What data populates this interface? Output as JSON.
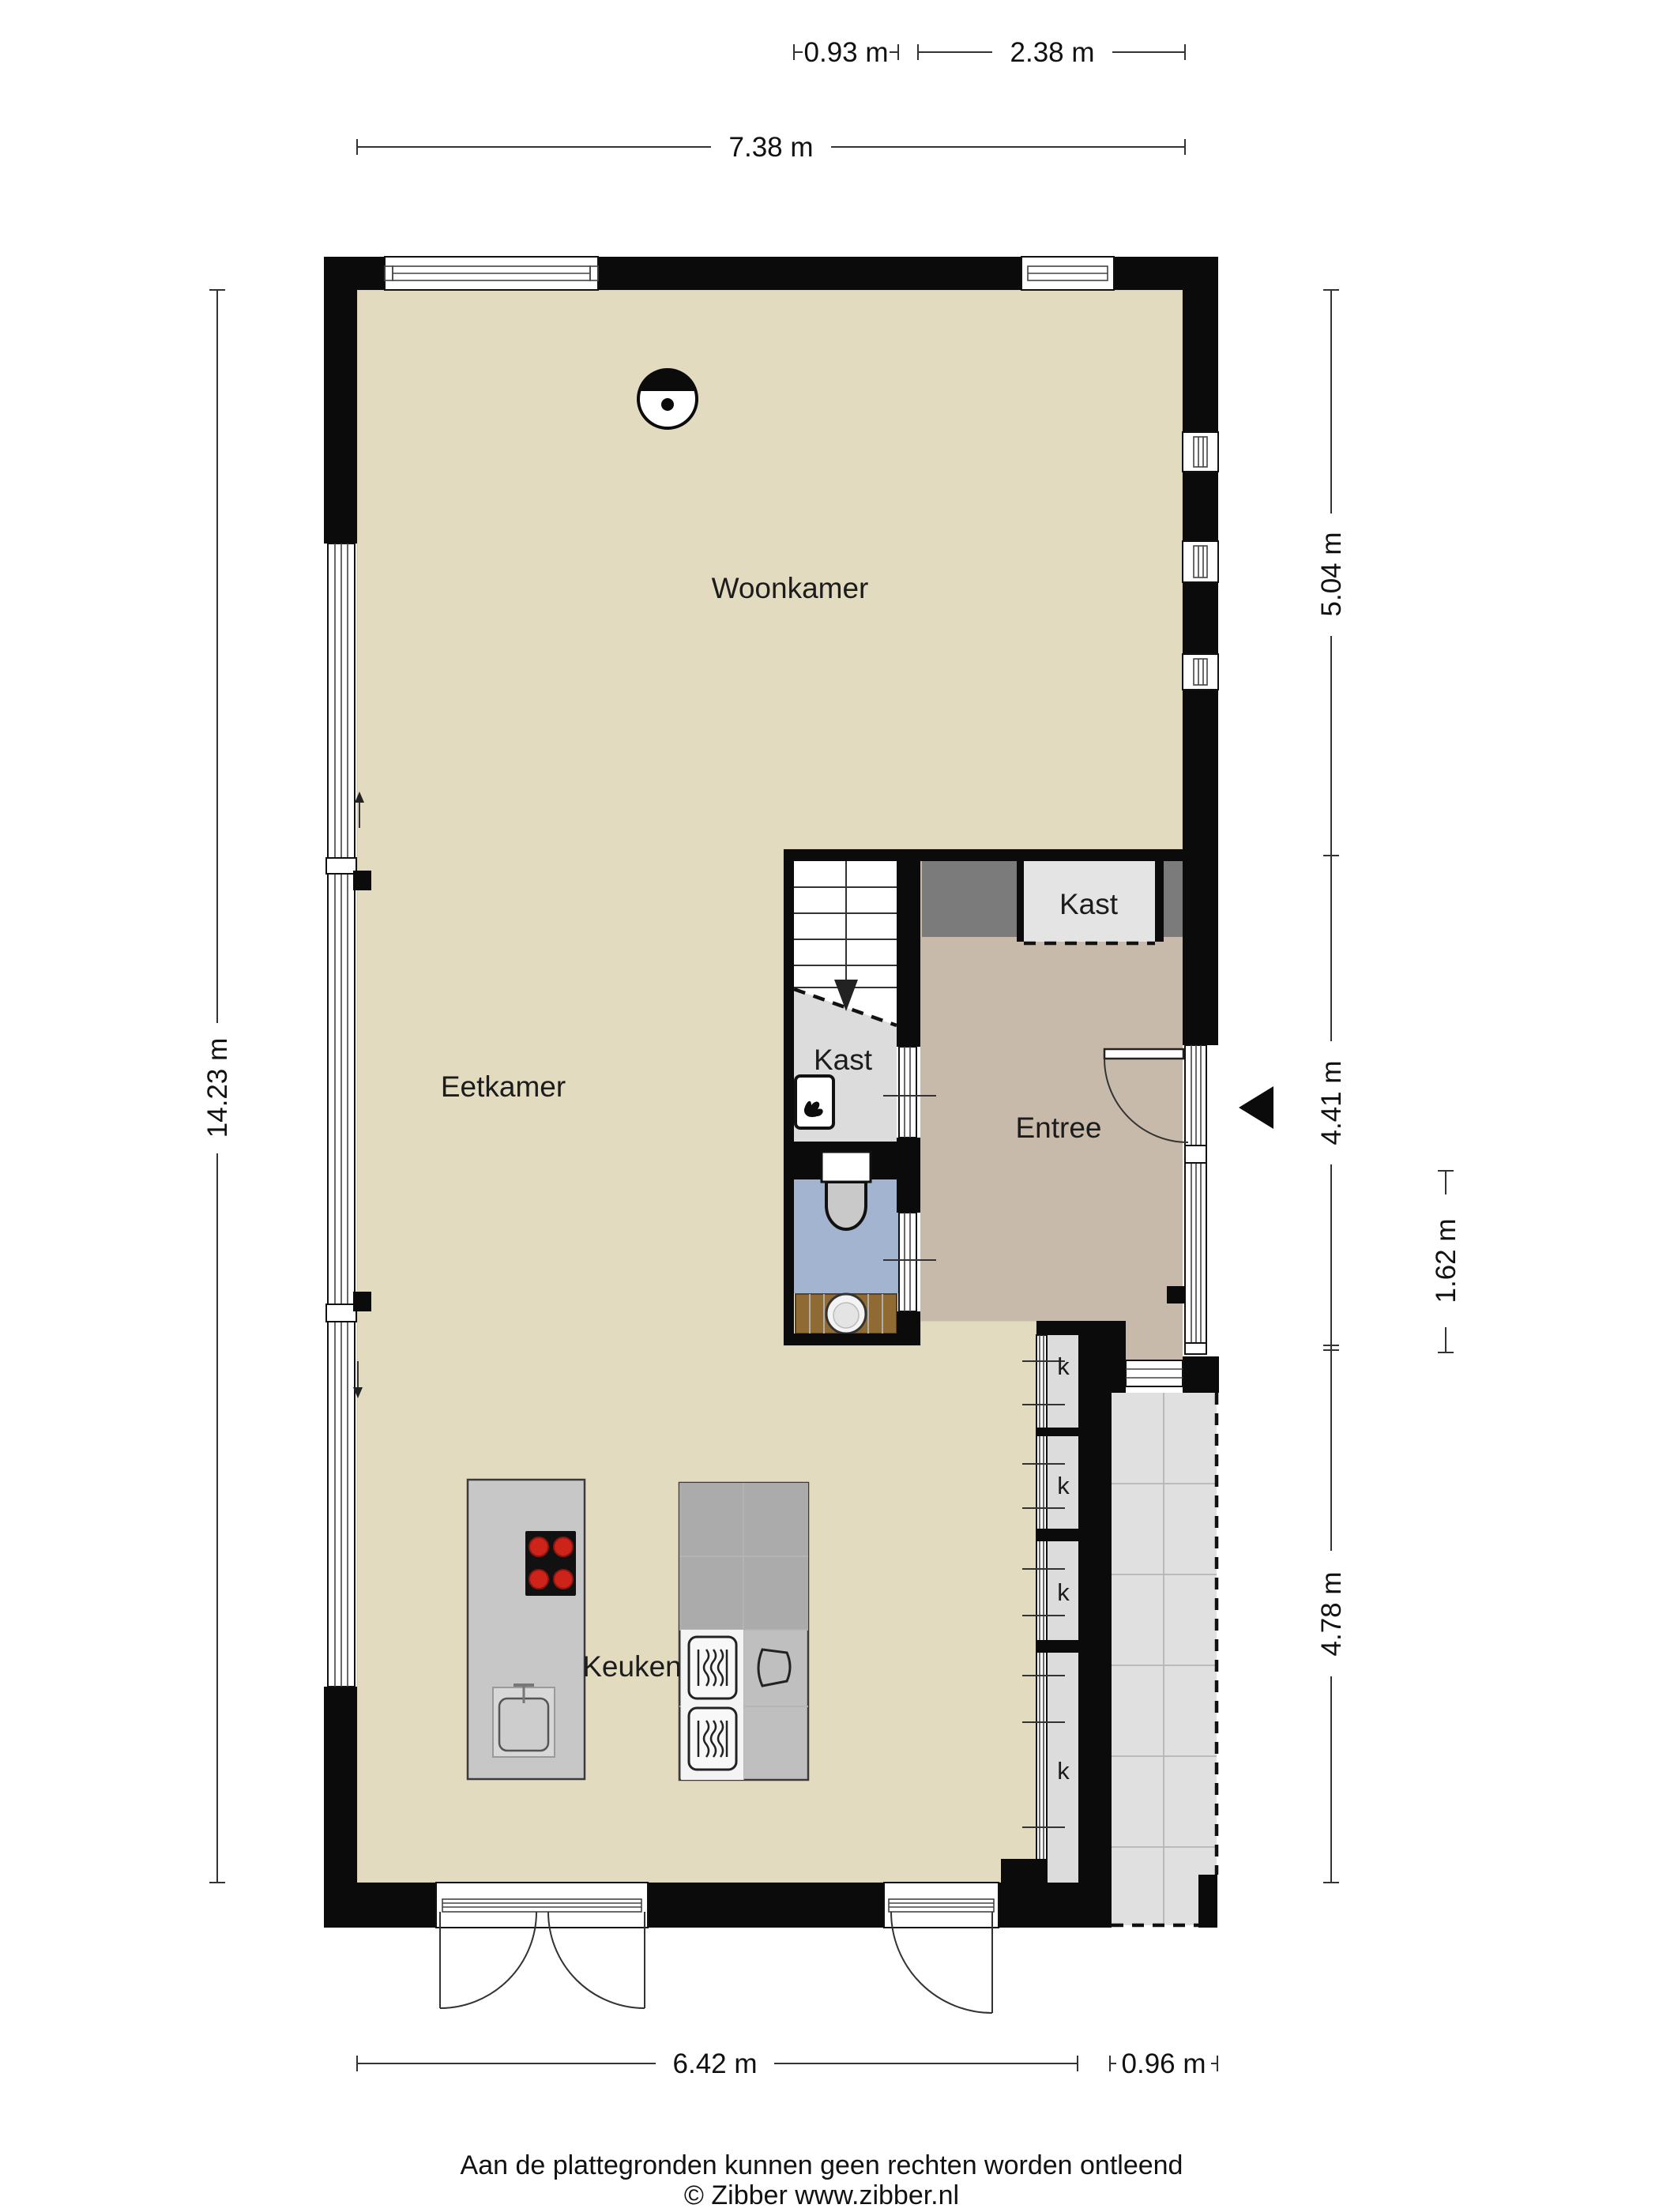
{
  "dims": {
    "w093": "0.93 m",
    "w238": "2.38 m",
    "w738": "7.38 m",
    "h1423": "14.23 m",
    "h504": "5.04 m",
    "h441": "4.41 m",
    "h162": "1.62 m",
    "h478": "4.78 m",
    "w642": "6.42 m",
    "w096": "0.96 m"
  },
  "rooms": {
    "woonkamer": "Woonkamer",
    "eetkamer": "Eetkamer",
    "keuken": "Keuken",
    "entree": "Entree",
    "kast_top": "Kast",
    "kast_stairs": "Kast",
    "k1": "k",
    "k2": "k",
    "k3": "k",
    "k4": "k"
  },
  "footer": {
    "disclaimer": "Aan de plattegronden kunnen geen rechten worden ontleend",
    "copyright": "© Zibber www.zibber.nl"
  },
  "icons": {
    "ceiling_light": "circle-with-dot",
    "entrance_arrow": "left-pointing-triangle",
    "water_heater": "flame",
    "stairs_down": "down-arrow"
  },
  "colors": {
    "floor_beige": "#e2dbc0",
    "entree_taupe": "#c8baaa",
    "closet_gray": "#dcdcdc",
    "kast_light": "#e4e4e4",
    "toilet_blue": "#a2b4cf",
    "cabinet_dark": "#7b7b7b",
    "island_gray": "#c7c7c7",
    "counter_dark": "#ababab",
    "appliance_white": "#f4f4f4",
    "vanity_brown": "#8f6a33",
    "outdoor_gray": "#e0e0e0",
    "wall_black": "#0b0b0b",
    "burner_red": "#ce2318"
  }
}
